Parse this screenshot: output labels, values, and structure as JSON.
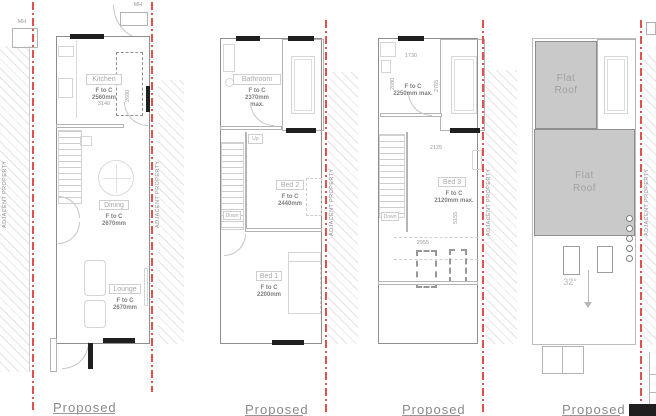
{
  "boundary_label": "ADJACENT PROPERTY",
  "captions": {
    "p1": "Proposed",
    "p2": "Proposed",
    "p3": "Proposed",
    "p4": "Proposed"
  },
  "labels": {
    "up": "Up",
    "down": "Down",
    "mh": "MH"
  },
  "p1": {
    "kitchen_label": "Kitchen",
    "kitchen_ftc1": "F to C",
    "kitchen_ftc2": "2560mm",
    "kitchen_dim": "3140",
    "appliance_dim": "2680",
    "dining_label": "Dining",
    "dining_ftc1": "F to C",
    "dining_ftc2": "2670mm",
    "lounge_label": "Lounge",
    "lounge_ftc1": "F to C",
    "lounge_ftc2": "2670mm"
  },
  "p2": {
    "bathroom_label": "Bathroom",
    "bathroom_ftc1": "F to C",
    "bathroom_ftc2": "2370mm",
    "bathroom_ftc3": "max.",
    "bed2_label": "Bed 2",
    "bed2_ftc1": "F to C",
    "bed2_ftc2": "2440mm",
    "bed1_label": "Bed 1",
    "bed1_ftc1": "F to C",
    "bed1_ftc2": "2200mm"
  },
  "p3": {
    "dim_1730": "1730",
    "dim_2080": "2080",
    "dim_2765": "2765",
    "ftc1": "F to C",
    "ftc2": "2250mm max.",
    "dim_2125": "2125",
    "bed3_label": "Bed 3",
    "bed3_ftc1": "F to C",
    "bed3_ftc2": "2120mm max.",
    "dim_5155": "5155",
    "dim_2955": "2955"
  },
  "p4": {
    "flat_roof_a": "Flat Roof",
    "flat_roof_b": "Flat Roof",
    "pitch": "32°"
  },
  "colors": {
    "boundary_red": "#e0534b",
    "flat_roof_gray": "#c9c9c9"
  }
}
